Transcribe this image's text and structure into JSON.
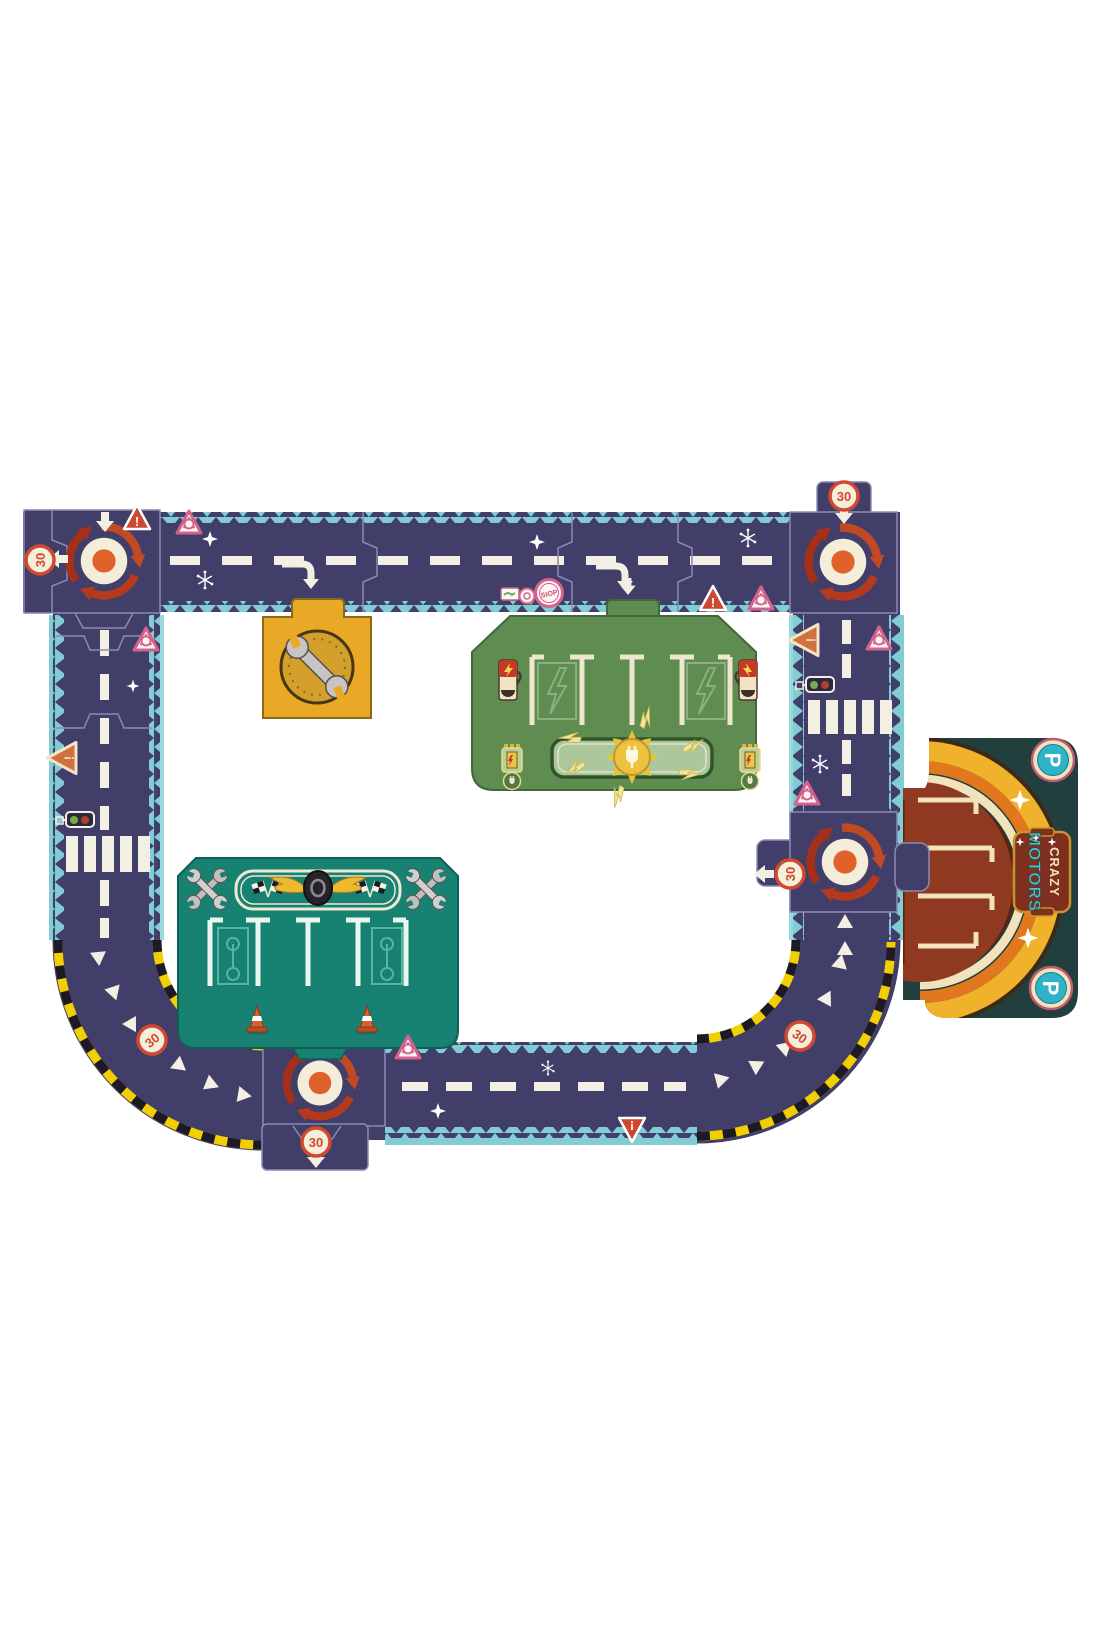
{
  "product": {
    "name": "Crazy Motors giant road circuit puzzle",
    "brand": {
      "line1": "CRAZY",
      "line2": "MOTORS"
    }
  },
  "signs": {
    "speed30": "30",
    "stop": "StOP",
    "warning": "!",
    "parking": "P"
  },
  "pieces": {
    "roundabouts": 4,
    "list": [
      "roundabout-top-left",
      "roundabout-top-right",
      "roundabout-mid-right",
      "roundabout-bottom",
      "garage-wrench-piece",
      "charging-station-piece",
      "pit-stop-piece",
      "parking-piece",
      "curve-bottom-left",
      "curve-bottom-right"
    ]
  },
  "colors": {
    "road_navy": "#423e6a",
    "edge_teal": "#82ccd4",
    "arrow_red": "#b5391c",
    "dot_orange": "#e0622a",
    "cream": "#f4edda",
    "sign_red": "#cf4631",
    "sign_pink": "#d4638b",
    "garage_yellow": "#e9a826",
    "station_green": "#5f8c50",
    "pit_teal": "#178172",
    "parking_bg": "#21403d",
    "parking_maroon": "#8f3a20",
    "arch_orange": "#e1771f",
    "arch_yellow": "#f0b22b",
    "hazard_yellow": "#f2cf00"
  }
}
